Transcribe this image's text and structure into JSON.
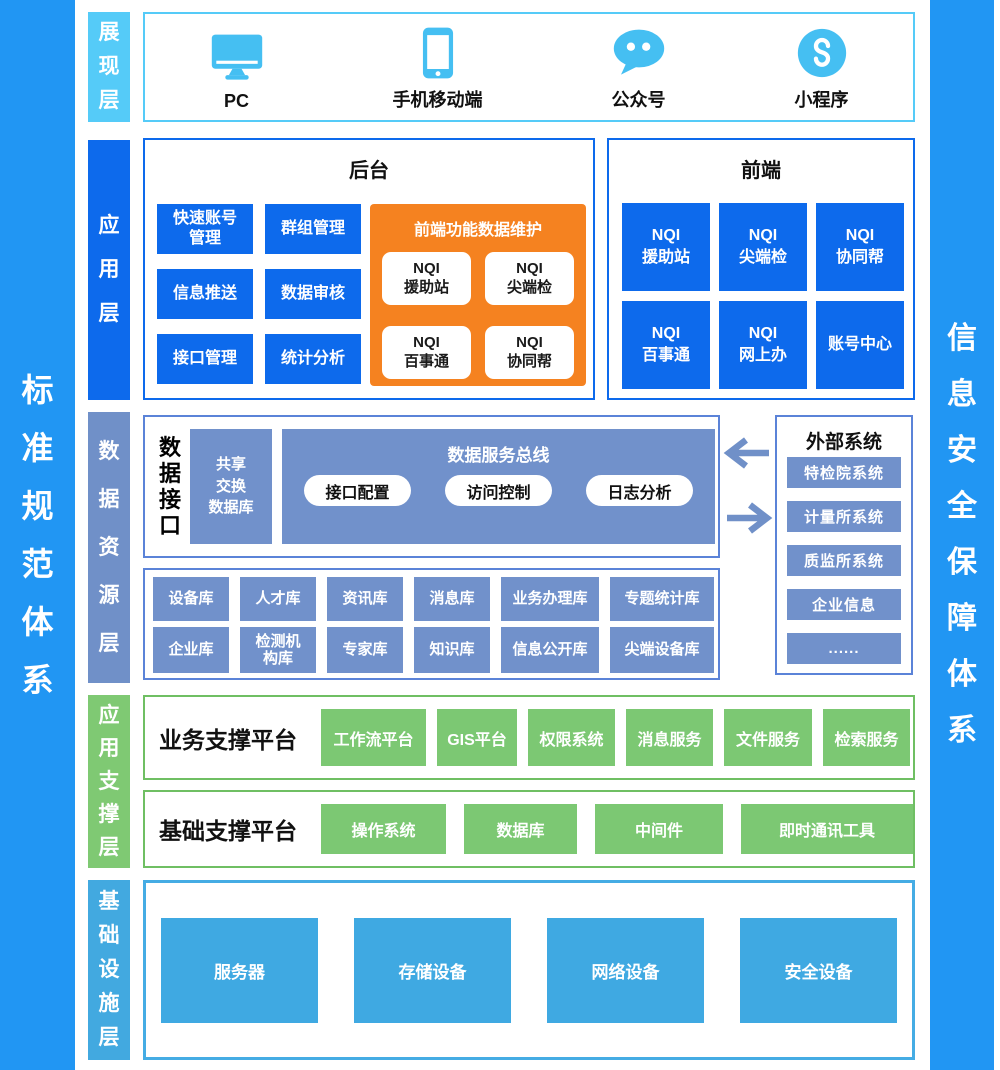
{
  "banners": {
    "left": "标\n准\n规\n范\n体\n系",
    "right": "信\n息\n安\n全\n保\n障\n体\n系"
  },
  "presentation": {
    "label": "展\n现\n层",
    "devices": [
      {
        "label": "PC",
        "icon": "pc-monitor-icon"
      },
      {
        "label": "手机移动端",
        "icon": "smartphone-icon"
      },
      {
        "label": "公众号",
        "icon": "official-account-icon"
      },
      {
        "label": "小程序",
        "icon": "mini-program-icon"
      }
    ]
  },
  "application": {
    "label": "应\n用\n层",
    "backend": {
      "title": "后台",
      "items": [
        "快速账号\n管理",
        "群组管理",
        "信息推送",
        "数据审核",
        "接口管理",
        "统计分析"
      ],
      "maintenance": {
        "title": "前端功能数据维护",
        "items": [
          "NQI\n援助站",
          "NQI\n尖端检",
          "NQI\n百事通",
          "NQI\n协同帮"
        ]
      }
    },
    "frontend": {
      "title": "前端",
      "items": [
        "NQI\n援助站",
        "NQI\n尖端检",
        "NQI\n协同帮",
        "NQI\n百事通",
        "NQI\n网上办",
        "账号中心"
      ]
    }
  },
  "data_resource": {
    "label": "数\n据\n资\n源\n层",
    "interface": {
      "title": "数\n据\n接\n口",
      "exchange_db": "共享\n交换\n数据库",
      "bus": {
        "title": "数据服务总线",
        "items": [
          "接口配置",
          "访问控制",
          "日志分析"
        ]
      }
    },
    "libraries": {
      "row1": [
        "设备库",
        "人才库",
        "资讯库",
        "消息库",
        "业务办理库",
        "专题统计库"
      ],
      "row2": [
        "企业库",
        "检测机\n构库",
        "专家库",
        "知识库",
        "信息公开库",
        "尖端设备库"
      ]
    },
    "external": {
      "title": "外部系统",
      "items": [
        "特检院系统",
        "计量所系统",
        "质监所系统",
        "企业信息",
        "......"
      ]
    }
  },
  "app_support": {
    "label": "应\n用\n支\n撑\n层",
    "business": {
      "title": "业务支撑平台",
      "items": [
        "工作流平台",
        "GIS平台",
        "权限系统",
        "消息服务",
        "文件服务",
        "检索服务"
      ]
    },
    "basic": {
      "title": "基础支撑平台",
      "items": [
        "操作系统",
        "数据库",
        "中间件",
        "即时通讯工具"
      ]
    }
  },
  "infrastructure": {
    "label": "基\n础\n设\n施\n层",
    "items": [
      "服务器",
      "存储设备",
      "网络设备",
      "安全设备"
    ]
  },
  "colors": {
    "banner_blue": "#2196F3",
    "sky_light": "#55CBF8",
    "icon_blue": "#45BFF2",
    "primary_blue": "#0D6AEC",
    "muted_blue": "#7191CB",
    "muted_border": "#5B83D8",
    "green": "#7CC873",
    "green_border": "#6FBF63",
    "orange": "#F58220",
    "sky": "#3FA9E2"
  }
}
